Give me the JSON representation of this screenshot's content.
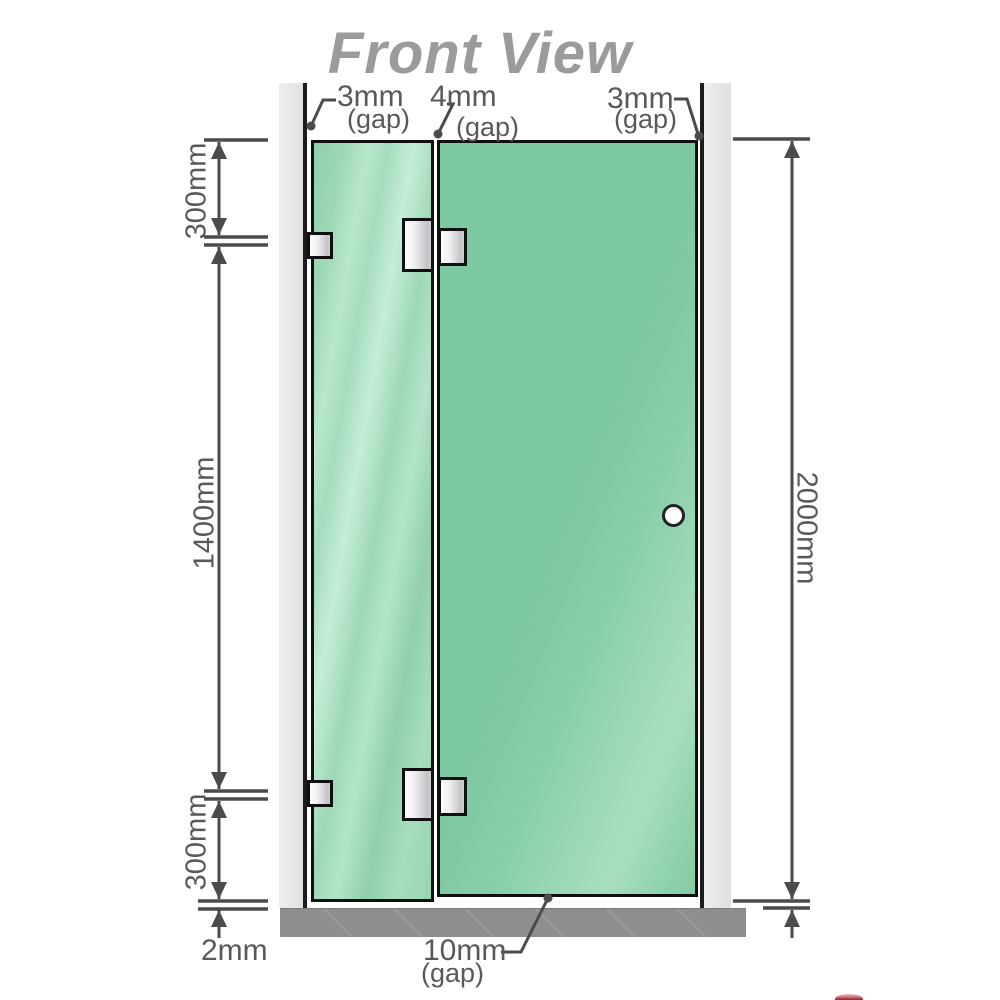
{
  "title": "Front View",
  "annotations": {
    "top_left_gap": {
      "value": "3mm",
      "label": "(gap)"
    },
    "top_middle_gap": {
      "value": "4mm",
      "label": "(gap)"
    },
    "top_right_gap": {
      "value": "3mm",
      "label": "(gap)"
    },
    "bottom_gap": {
      "value": "10mm",
      "label": "(gap)"
    }
  },
  "dimensions": {
    "left_top": "300mm",
    "left_middle": "1400mm",
    "left_bottom": "300mm",
    "bottom_floor_gap": "2mm",
    "right_total_height": "2000mm"
  },
  "colors": {
    "glass_green": "#7cc8a0",
    "glass_green_light": "#b9e7cc",
    "wall_channel_gray": "#e6e6e9",
    "floor_gray": "#8e8e90",
    "dimension_line": "#4b4b4b",
    "label_text": "#595959",
    "title_gray": "#9b9b9b",
    "watermark_red": "#8e1f2c"
  }
}
